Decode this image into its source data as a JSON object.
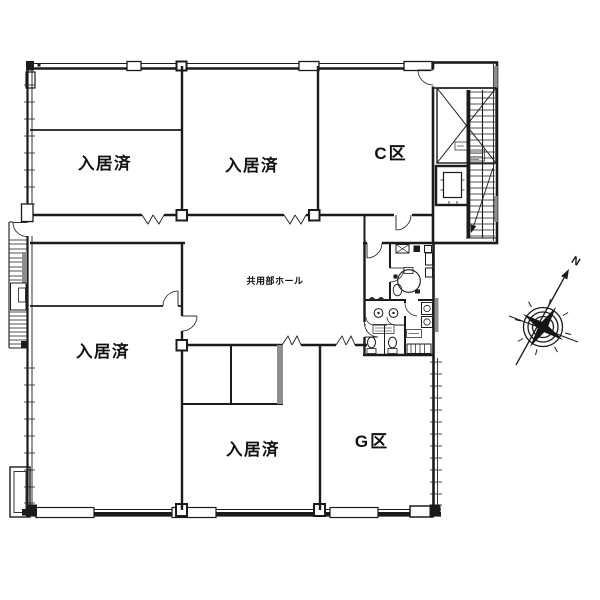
{
  "plan": {
    "rooms": [
      {
        "id": "top-left",
        "label": "入居済"
      },
      {
        "id": "top-center",
        "label": "入居済"
      },
      {
        "id": "top-right",
        "label": "C区"
      },
      {
        "id": "hall",
        "label": "共用部ホール"
      },
      {
        "id": "bottom-left",
        "label": "入居済"
      },
      {
        "id": "bottom-center",
        "label": "入居済"
      },
      {
        "id": "bottom-right",
        "label": "G区"
      }
    ],
    "compass": {
      "north_label": "N"
    },
    "colors": {
      "line": "#1b1b1b",
      "shaded_wall": "#8e8e8e",
      "background": "#ffffff"
    }
  }
}
